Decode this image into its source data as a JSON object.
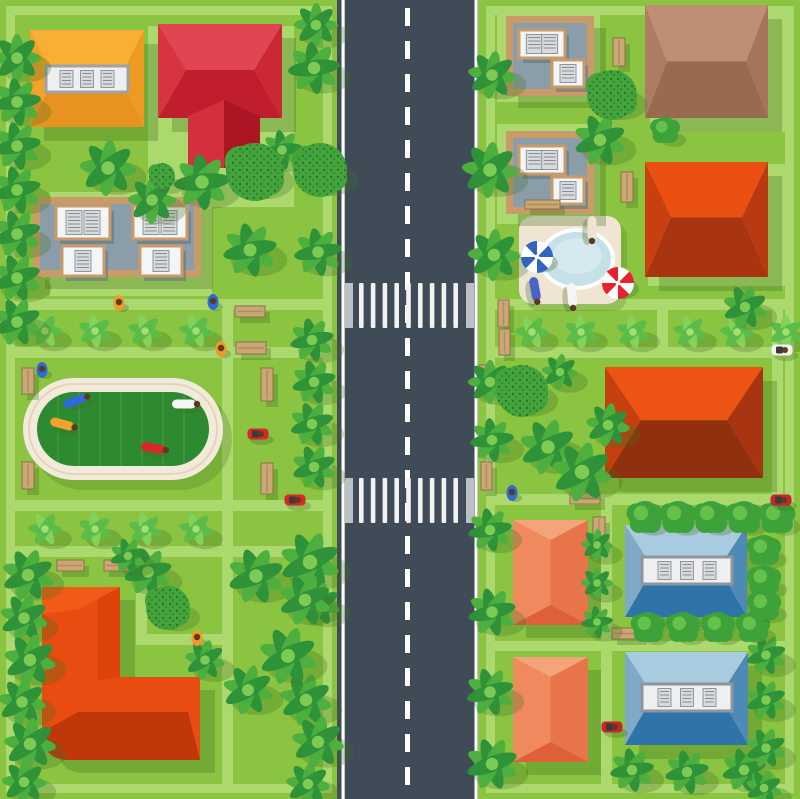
{
  "illustration": {
    "label": "top-view-city-neighborhood-map",
    "width": 800,
    "height": 799
  },
  "palette": {
    "grass": "#8AC441",
    "path": "#ACD96E",
    "road": "#3F4B57",
    "road_line": "#FFFFFF",
    "cross_end": "#B9C0C6",
    "cross_stripe": "#F2F2F2",
    "track_ring": "#F2EBDB",
    "track_line": "#E2D5BC",
    "field": "#2E8A31",
    "field_stripe": "#4A9C44",
    "shadow": "#3F6E1F",
    "tree_dark": "#2E9139",
    "tree_mid": "#4CAF3E",
    "tree_light": "#7DCB52",
    "bush_light": "#5ABB4A",
    "bush_lighter": "#86D35C",
    "round_bush": "#3EA23A",
    "round_bush_hi": "#66C14A",
    "speckle_base": "#44A43C",
    "speckle_dot": "#1F6B26",
    "bench_wood": "#C9A876",
    "bench_line": "#8F6F4A",
    "patio": "#F0E5D3",
    "pool_rim": "#FFFFFF",
    "pool_water": "#C6E0E7",
    "pool_water_hi": "#D6E9EE",
    "tan": "#C89B69",
    "gray_roof": "#8B9DA9",
    "panel_face": "#F4F5F6",
    "panel_shadow": "#5E7280",
    "vent_face": "#D8DBDE",
    "vent_line": "#878D93",
    "skin_head": "#5D3A1F"
  },
  "frames": [
    [
      10.5,
      10.5,
      317,
      778
    ],
    [
      490.5,
      10.5,
      299,
      778
    ]
  ],
  "pads": [
    [
      148,
      26,
      146,
      181
    ],
    [
      50,
      192,
      162,
      104
    ],
    [
      497,
      8,
      103,
      94
    ],
    [
      497,
      124,
      103,
      100
    ],
    [
      650,
      8,
      142,
      124
    ],
    [
      648,
      164,
      146,
      122
    ]
  ],
  "paths": [
    [
      10,
      299,
      313,
      11
    ],
    [
      10,
      347,
      313,
      11
    ],
    [
      10,
      500,
      313,
      11
    ],
    [
      10,
      546,
      313,
      11
    ],
    [
      222,
      299,
      11,
      492
    ],
    [
      136,
      556,
      11,
      89
    ],
    [
      136,
      634,
      97,
      11
    ],
    [
      486,
      299,
      308,
      11
    ],
    [
      486,
      347,
      308,
      11
    ],
    [
      657,
      299,
      11,
      59
    ],
    [
      486,
      494,
      308,
      11
    ],
    [
      601,
      494,
      11,
      297
    ],
    [
      601,
      641,
      193,
      10
    ],
    [
      486,
      641,
      116,
      10
    ],
    [
      772,
      310,
      11,
      185
    ]
  ],
  "road": {
    "x": 337,
    "w": 141,
    "edge_lines": [
      341.5,
      474.5
    ],
    "edge_w": 3.2,
    "dash_x": 407.5,
    "dash_w": 5,
    "dash_pattern": [
      18,
      15
    ],
    "crosswalks": [
      {
        "y": 283,
        "h": 45
      },
      {
        "y": 478,
        "h": 45
      }
    ],
    "stripe_start": 359,
    "stripe_step": 11.8,
    "stripe_w": 4.6,
    "stripe_count": 9,
    "end_bars": [
      345,
      466
    ],
    "end_bar_w": 8
  },
  "stadium": {
    "x": 23,
    "y": 378,
    "w": 200,
    "h": 102,
    "ring": 14,
    "stripe_gap": 21
  },
  "pool": {
    "patio": [
      519,
      216,
      102,
      88
    ],
    "ellipse": [
      577,
      259,
      34,
      27
    ]
  },
  "flat_buildings": [
    {
      "x": 33,
      "y": 197,
      "w": 168,
      "h": 80,
      "panels": [
        [
          56,
          206,
          54,
          33,
          2
        ],
        [
          133,
          206,
          54,
          33,
          2
        ],
        [
          62,
          246,
          42,
          30,
          1
        ],
        [
          140,
          246,
          42,
          30,
          1
        ]
      ]
    },
    {
      "x": 506,
      "y": 16,
      "w": 88,
      "h": 80,
      "panels": [
        [
          519,
          30,
          46,
          28,
          2
        ],
        [
          552,
          60,
          32,
          27,
          1
        ]
      ]
    },
    {
      "x": 506,
      "y": 131,
      "w": 88,
      "h": 83,
      "panels": [
        [
          519,
          146,
          46,
          28,
          2
        ],
        [
          552,
          177,
          32,
          27,
          1
        ]
      ]
    }
  ],
  "hip_houses": [
    {
      "x": 30,
      "y": 30,
      "w": 114,
      "h": 97,
      "ins": 24,
      "rf": 0.5,
      "top": "#F8AF34",
      "bottom": "#E8931F",
      "left": "#F3A127",
      "right": "#EE9A22",
      "strip": [
        46,
        66,
        82,
        26,
        3,
        "#9CA3AA"
      ]
    },
    {
      "x": 158,
      "y": 24,
      "w": 124,
      "h": 94,
      "ins": 28,
      "rf": 0.49,
      "top": "#E14552",
      "bottom": "#C11E2D",
      "left": "#D53440",
      "right": "#CB2836"
    },
    {
      "x": 645,
      "y": 5,
      "w": 123,
      "h": 113,
      "ins": 22,
      "rf": 0.5,
      "top": "#BE8F74",
      "bottom": "#9A6A4F",
      "left": "#AD7D61",
      "right": "#A5755A"
    },
    {
      "x": 645,
      "y": 162,
      "w": 123,
      "h": 115,
      "ins": 26,
      "rf": 0.48,
      "top": "#EB4F12",
      "bottom": "#A93410",
      "left": "#C84010",
      "right": "#B93A10"
    },
    {
      "x": 605,
      "y": 367,
      "w": 158,
      "h": 111,
      "ins": 36,
      "rf": 0.48,
      "top": "#ED5414",
      "bottom": "#90300F",
      "left": "#C63F0F",
      "right": "#A93410"
    },
    {
      "x": 625,
      "y": 525,
      "w": 122,
      "h": 92,
      "ins": 28,
      "rf": 0.47,
      "top": "#A9CBDF",
      "bottom": "#2F74A8",
      "left": "#7FA9C8",
      "right": "#4E8AB6",
      "strip": [
        642,
        557,
        90,
        27,
        3,
        "#8E959B"
      ]
    },
    {
      "x": 625,
      "y": 652,
      "w": 123,
      "h": 93,
      "ins": 28,
      "rf": 0.47,
      "top": "#A9CBDF",
      "bottom": "#2F74A8",
      "left": "#7FA9C8",
      "right": "#4E8AB6",
      "strip": [
        642,
        684,
        90,
        27,
        3,
        "#8E959B"
      ]
    }
  ],
  "gable_houses": [
    {
      "x": 513,
      "y": 520,
      "w": 75,
      "h": 105,
      "ins": 20,
      "top": "#F5A37A",
      "left": "#F08A5E",
      "right": "#E8744A",
      "bottom": "#DF6038"
    },
    {
      "x": 513,
      "y": 657,
      "w": 75,
      "h": 105,
      "ins": 20,
      "top": "#F5A37A",
      "left": "#F08A5E",
      "right": "#E8744A",
      "bottom": "#DF6038"
    }
  ],
  "red_wing": [
    {
      "pts": "188,116 224,100 224,168 188,168",
      "fill": "#D42F3D"
    },
    {
      "pts": "224,100 260,116 260,168 224,168",
      "fill": "#AC1523"
    }
  ],
  "l_house": {
    "base": "M42,587 L120,587 L120,677 L200,677 L200,760 L70,760 Q42,760 42,732 Z",
    "base_fill": "#E94C10",
    "facets": [
      {
        "d": "M78,712 L188,712 L200,760 L70,760 Q42,760 42,732 Z",
        "fill": "#C0370A"
      },
      {
        "d": "M98,590 L120,587 L120,677 L98,680 Z",
        "fill": "#DB4309"
      },
      {
        "d": "M42,587 L120,587 L79,609 L42,614 Z",
        "fill": "#F25A17"
      }
    ]
  },
  "palm_trees": [
    [
      17,
      58,
      24
    ],
    [
      17,
      102,
      24
    ],
    [
      17,
      146,
      24
    ],
    [
      17,
      190,
      24
    ],
    [
      17,
      234,
      24
    ],
    [
      17,
      278,
      24
    ],
    [
      17,
      322,
      24
    ],
    [
      28,
      575,
      26
    ],
    [
      24,
      618,
      24
    ],
    [
      30,
      660,
      26
    ],
    [
      22,
      702,
      24
    ],
    [
      30,
      744,
      26
    ],
    [
      24,
      782,
      22
    ],
    [
      316,
      25,
      22
    ],
    [
      314,
      68,
      26
    ],
    [
      318,
      252,
      24
    ],
    [
      312,
      340,
      22
    ],
    [
      314,
      382,
      22
    ],
    [
      312,
      424,
      22
    ],
    [
      314,
      467,
      22
    ],
    [
      310,
      562,
      30
    ],
    [
      318,
      604,
      22
    ],
    [
      306,
      700,
      26
    ],
    [
      318,
      742,
      26
    ],
    [
      308,
      784,
      22
    ],
    [
      108,
      168,
      28
    ],
    [
      152,
      200,
      24
    ],
    [
      202,
      182,
      28
    ],
    [
      282,
      150,
      20
    ],
    [
      250,
      250,
      27
    ],
    [
      148,
      572,
      24
    ],
    [
      128,
      556,
      18
    ],
    [
      256,
      576,
      28
    ],
    [
      305,
      600,
      26
    ],
    [
      288,
      656,
      29
    ],
    [
      248,
      690,
      25
    ],
    [
      205,
      660,
      20
    ],
    [
      492,
      75,
      24
    ],
    [
      490,
      170,
      28
    ],
    [
      494,
      255,
      26
    ],
    [
      490,
      382,
      22
    ],
    [
      492,
      440,
      22
    ],
    [
      490,
      530,
      22
    ],
    [
      492,
      612,
      24
    ],
    [
      490,
      692,
      24
    ],
    [
      492,
      764,
      26
    ],
    [
      600,
      140,
      26
    ],
    [
      745,
      307,
      22
    ],
    [
      548,
      447,
      28
    ],
    [
      582,
      472,
      30
    ],
    [
      608,
      425,
      22
    ],
    [
      560,
      372,
      18
    ],
    [
      597,
      545,
      16
    ],
    [
      597,
      583,
      16
    ],
    [
      597,
      622,
      16
    ],
    [
      632,
      770,
      22
    ],
    [
      687,
      772,
      22
    ],
    [
      744,
      770,
      22
    ],
    [
      766,
      655,
      20
    ],
    [
      766,
      700,
      20
    ],
    [
      766,
      748,
      20
    ],
    [
      764,
      788,
      18
    ]
  ],
  "speckled_trees": [
    [
      320,
      170,
      27
    ],
    [
      255,
      172,
      29
    ],
    [
      162,
      176,
      13
    ],
    [
      168,
      608,
      22
    ],
    [
      612,
      95,
      25
    ],
    [
      522,
      391,
      26
    ]
  ],
  "round_bushes": [
    [
      645,
      517,
      16
    ],
    [
      678,
      517,
      16
    ],
    [
      711,
      517,
      16
    ],
    [
      744,
      517,
      16
    ],
    [
      777,
      517,
      16
    ],
    [
      648,
      627,
      15
    ],
    [
      683,
      627,
      15
    ],
    [
      718,
      627,
      15
    ],
    [
      753,
      627,
      15
    ],
    [
      764,
      550,
      15
    ],
    [
      764,
      580,
      15
    ],
    [
      764,
      605,
      15
    ],
    [
      665,
      130,
      13
    ]
  ],
  "row_bushes": [
    [
      45,
      331,
      17
    ],
    [
      95,
      331,
      17
    ],
    [
      145,
      331,
      17
    ],
    [
      196,
      331,
      17
    ],
    [
      45,
      529,
      17
    ],
    [
      95,
      529,
      17
    ],
    [
      145,
      529,
      17
    ],
    [
      196,
      529,
      17
    ],
    [
      532,
      332,
      17
    ],
    [
      581,
      332,
      17
    ],
    [
      633,
      332,
      17
    ],
    [
      690,
      332,
      17
    ],
    [
      737,
      332,
      17
    ],
    [
      786,
      332,
      17
    ]
  ],
  "benches": [
    [
      235,
      306,
      30,
      11
    ],
    [
      236,
      342,
      30,
      12
    ],
    [
      261,
      368,
      12,
      33
    ],
    [
      261,
      463,
      12,
      31
    ],
    [
      22,
      368,
      12,
      26
    ],
    [
      22,
      462,
      12,
      27
    ],
    [
      57,
      560,
      27,
      11
    ],
    [
      104,
      560,
      27,
      11
    ],
    [
      613,
      38,
      12,
      28
    ],
    [
      621,
      172,
      12,
      30
    ],
    [
      498,
      300,
      11,
      27
    ],
    [
      499,
      329,
      11,
      26
    ],
    [
      479,
      365,
      11,
      28
    ],
    [
      481,
      462,
      11,
      28
    ],
    [
      570,
      493,
      30,
      11
    ],
    [
      593,
      517,
      12,
      30
    ],
    [
      612,
      628,
      30,
      11
    ],
    [
      525,
      200,
      35,
      9
    ]
  ],
  "people": [
    [
      119,
      303,
      "#F2992B"
    ],
    [
      213,
      302,
      "#2E6BD6"
    ],
    [
      221,
      349,
      "#F2992B"
    ],
    [
      42,
      370,
      "#2E6BD6"
    ],
    [
      197,
      638,
      "#F2992B"
    ],
    [
      512,
      493,
      "#2E6BD6"
    ]
  ],
  "sunbathers": [
    [
      75,
      401,
      "#2E6BD6",
      -20
    ],
    [
      62,
      424,
      "#F2A32B",
      15
    ],
    [
      184,
      404,
      "#F5F5F5",
      0
    ],
    [
      153,
      448,
      "#D8262C",
      10
    ],
    [
      592,
      228,
      "#EFE3D2",
      90
    ],
    [
      535,
      289,
      "#4A62C9",
      80
    ],
    [
      572,
      295,
      "#F5F5F5",
      85
    ]
  ],
  "mowers": [
    [
      258,
      434,
      "#D8262C"
    ],
    [
      295,
      500,
      "#D8262C"
    ],
    [
      781,
      500,
      "#C8242B"
    ],
    [
      612,
      727,
      "#C8242B"
    ],
    [
      782,
      350,
      "#F2F2F2"
    ]
  ],
  "umbrellas": [
    [
      537,
      257,
      16,
      "#2F64C1"
    ],
    [
      618,
      283,
      16,
      "#E5232F"
    ]
  ]
}
